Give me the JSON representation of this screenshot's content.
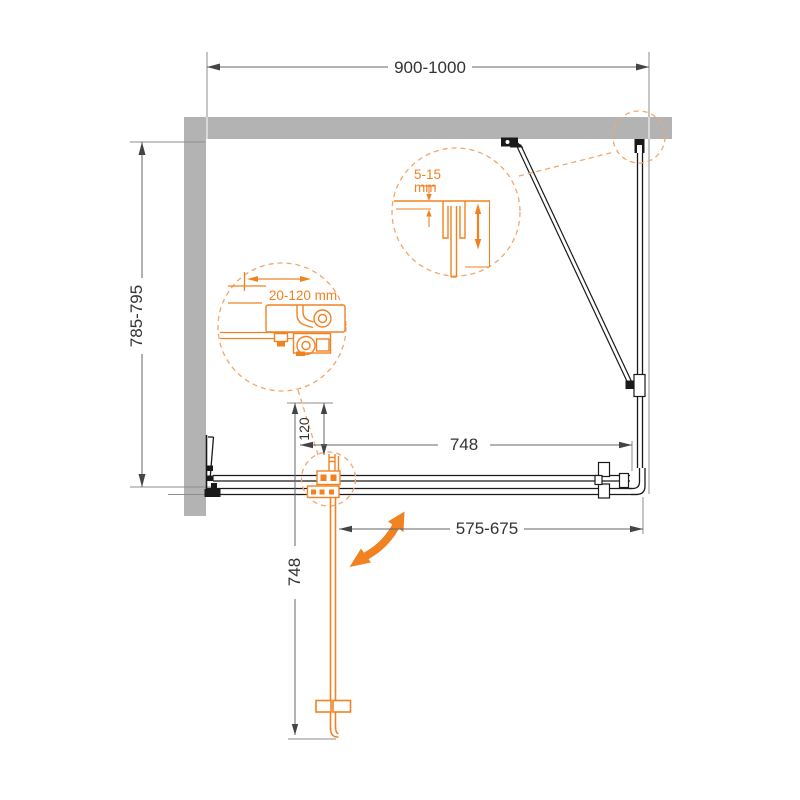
{
  "drawing": {
    "labels": {
      "overall_width": "900-1000",
      "overall_depth": "785-795",
      "hinge_offset": "120",
      "door_width": "748",
      "door_open_depth": "748",
      "entry_width": "575-675"
    },
    "details": {
      "wall_profile_adjust_value": "5-15",
      "wall_profile_adjust_unit": "mm",
      "wall_bracket_adjust_range": "20-120 mm"
    },
    "colors": {
      "wall": "#b3b3b3",
      "line": "#1a1a1a",
      "dimension": "#666666",
      "accent": "#f18222",
      "accent_light": "#f4a66a"
    }
  }
}
